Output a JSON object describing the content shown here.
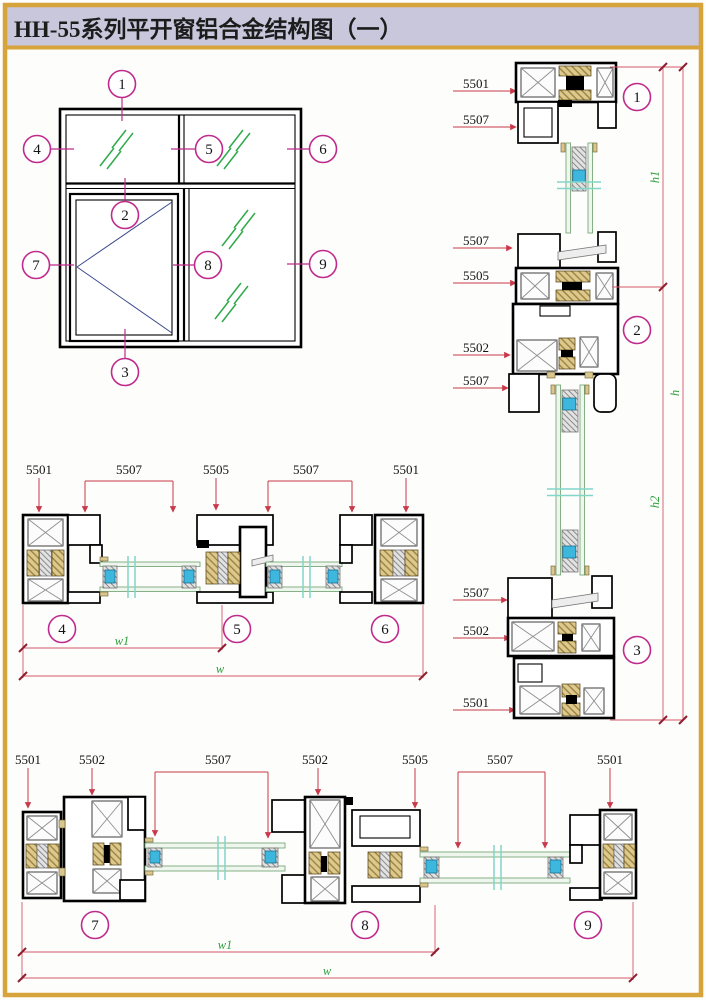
{
  "title": "HH-55系列平开窗铝合金结构图（一）",
  "elevation": {
    "callouts": [
      "1",
      "2",
      "3",
      "4",
      "5",
      "6",
      "7",
      "8",
      "9"
    ]
  },
  "right": {
    "labels": [
      "5501",
      "5507",
      "5507",
      "5505",
      "5502",
      "5507",
      "5507",
      "5502",
      "5501"
    ],
    "callouts": [
      "1",
      "2",
      "3"
    ],
    "dim_h1": "h1",
    "dim_h": "h",
    "dim_h2": "h2"
  },
  "mid": {
    "labels": [
      "5501",
      "5507",
      "5505",
      "5507",
      "5501"
    ],
    "callouts": [
      "4",
      "5",
      "6"
    ],
    "dim_w1": "w1",
    "dim_w": "w"
  },
  "bottom": {
    "labels": [
      "5501",
      "5502",
      "5507",
      "5502",
      "5505",
      "5507",
      "5501"
    ],
    "callouts": [
      "7",
      "8",
      "9"
    ],
    "dim_w1": "w1",
    "dim_w": "w"
  },
  "colors": {
    "border_gold": "#d7a33b",
    "header_bg": "#c9c7dc",
    "dim_red": "#c9394a",
    "callout_magenta": "#bf2a8c",
    "dim_text_green": "#2e9e3e",
    "glass_hatch_green": "#2faa4a",
    "profile_black": "#000000",
    "bead_tan": "#d9c68e",
    "glass_edge_green": "#7aa97a",
    "break_cyan": "#82d5c9",
    "spacer_blue": "#3db7dd"
  }
}
